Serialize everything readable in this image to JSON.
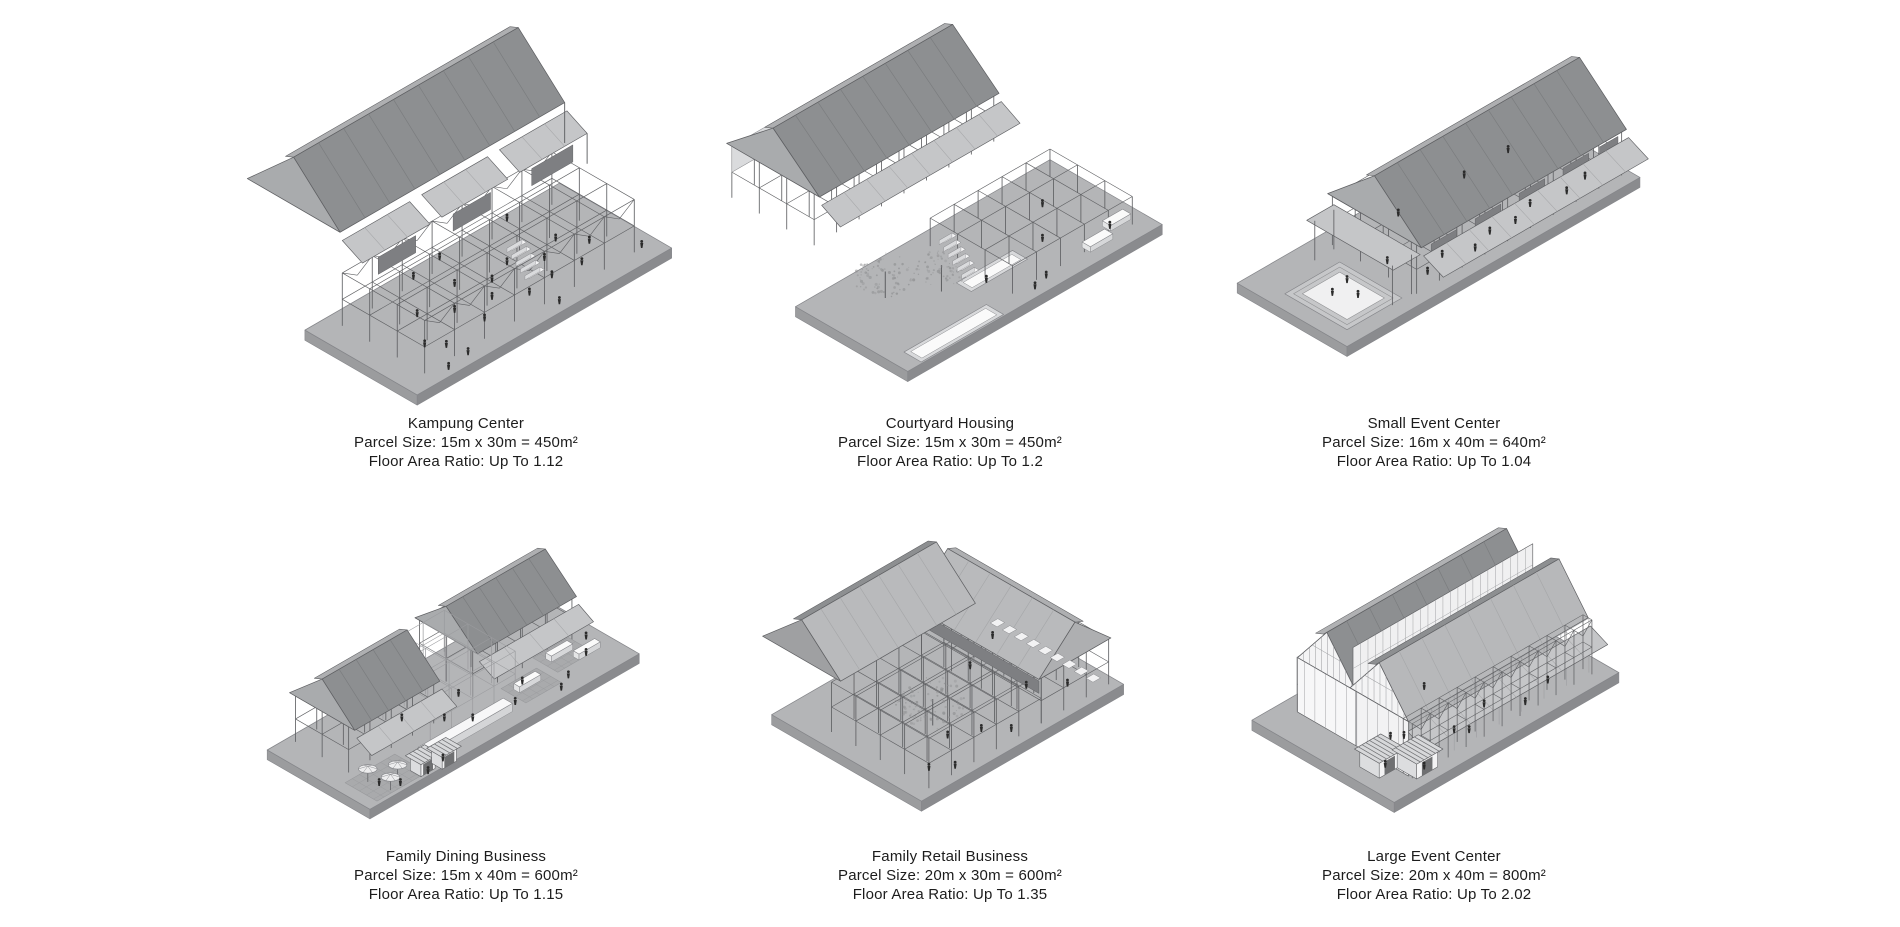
{
  "page": {
    "background": "#ffffff",
    "text_color": "#1c1c1c"
  },
  "palette": {
    "background": "#ffffff",
    "ink": "#1c1c1c",
    "plate": "#b4b5b7",
    "plate_edge": "#85868a",
    "plate_side": "#9b9c9e",
    "plate_side2": "#8a8b8e",
    "roof_dark": "#8d8f91",
    "roof_mid": "#aeafb1",
    "roof_light": "#c5c6c8",
    "roof_light2": "#b9babc",
    "seam_dark": "#7a7c7e",
    "seam_light": "#a6a7a9",
    "line": "#5f6063",
    "line_light": "#9b9c9f",
    "wall_dark": "#7e7f82",
    "tree": "#8f9092",
    "people": "#2b2b2b",
    "hatch": "#a9aaac",
    "hatch_line": "#97989b",
    "white": "#ffffff"
  },
  "buildings": [
    {
      "id": "kampung-center",
      "title": "Kampung Center",
      "parcel_size": "Parcel Size: 15m x 30m = 450m²",
      "floor_area_ratio": "Floor Area Ratio: Up To 1.12"
    },
    {
      "id": "courtyard-housing",
      "title": "Courtyard Housing",
      "parcel_size": "Parcel Size: 15m x 30m = 450m²",
      "floor_area_ratio": "Floor Area Ratio: Up To 1.2"
    },
    {
      "id": "small-event-center",
      "title": "Small Event Center",
      "parcel_size": "Parcel Size: 16m x 40m = 640m²",
      "floor_area_ratio": "Floor Area Ratio: Up To 1.04"
    },
    {
      "id": "family-dining-business",
      "title": "Family Dining Business",
      "parcel_size": "Parcel Size: 15m x 40m = 600m²",
      "floor_area_ratio": "Floor Area Ratio: Up To 1.15"
    },
    {
      "id": "family-retail-business",
      "title": "Family Retail Business",
      "parcel_size": "Parcel Size: 20m x 30m = 600m²",
      "floor_area_ratio": "Floor Area Ratio: Up To 1.35"
    },
    {
      "id": "large-event-center",
      "title": "Large Event Center",
      "parcel_size": "Parcel Size: 20m x 40m = 800m²",
      "floor_area_ratio": "Floor Area Ratio: Up To 2.02"
    }
  ]
}
